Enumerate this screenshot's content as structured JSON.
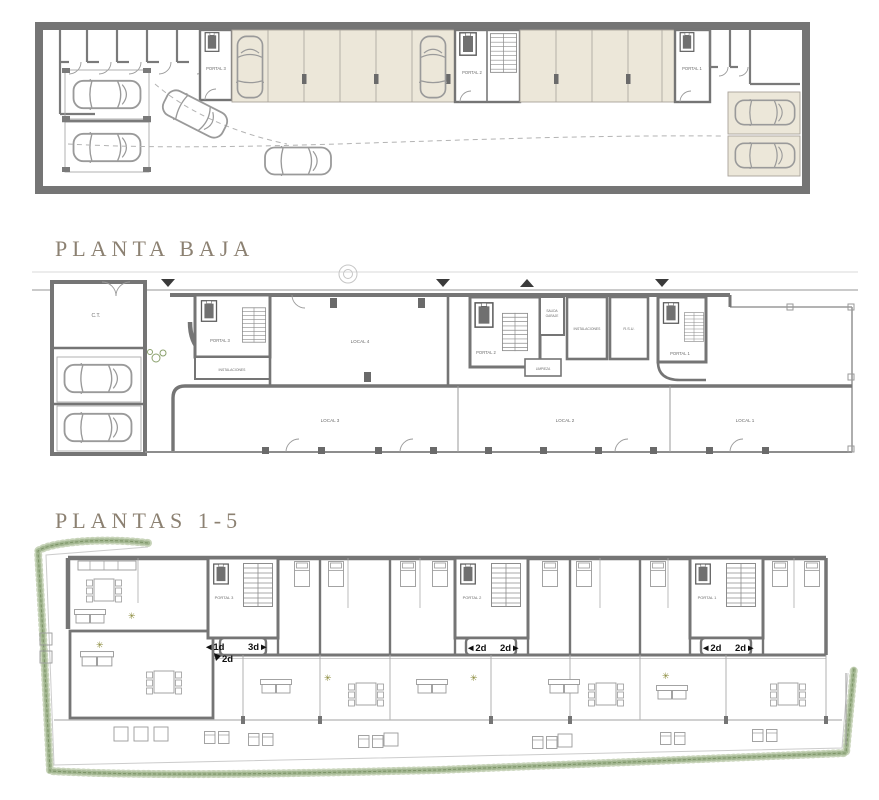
{
  "meta": {
    "type": "architectural-floor-plans",
    "width": 879,
    "height": 800
  },
  "colors": {
    "wall": "#757575",
    "thin_line": "#999999",
    "parking_fill": "#ece7d9",
    "hedge_green": "#a3b791",
    "title_text": "#8c8172",
    "room_label_text": "#6b6b6b",
    "unit_label_text": "#0f0f0f"
  },
  "titles": {
    "planta_baja": "PLANTA BAJA",
    "plantas_1_5": "PLANTAS 1-5"
  },
  "garage_plan": {
    "portal3": "PORTAL 3",
    "portal2": "PORTAL 2",
    "portal1": "PORTAL 1"
  },
  "planta_baja_plan": {
    "ct": "C.T.",
    "portal3": "PORTAL 3",
    "instalaciones_portal3": "INSTALACIONES",
    "local4": "LOCAL 4",
    "portal2": "PORTAL 2",
    "salida_line1": "SALIDA",
    "salida_line2": "GARAJE",
    "instalaciones": "INSTALACIONES",
    "rsu": "R.S.U.",
    "limpieza": "LIMPIEZA",
    "portal1": "PORTAL 1",
    "local3": "LOCAL 3",
    "local2": "LOCAL 2",
    "local1": "LOCAL 1"
  },
  "plantas_plan": {
    "portal3": "PORTAL 3",
    "portal2": "PORTAL 2",
    "portal1": "PORTAL 1",
    "unit_1d": "◄1d",
    "unit_2d_down": "2d",
    "unit_3d": "3d►",
    "p2_unit_left": "◄2d",
    "p2_unit_right": "2d►",
    "p1_unit_left": "◄2d",
    "p1_unit_right": "2d►"
  }
}
